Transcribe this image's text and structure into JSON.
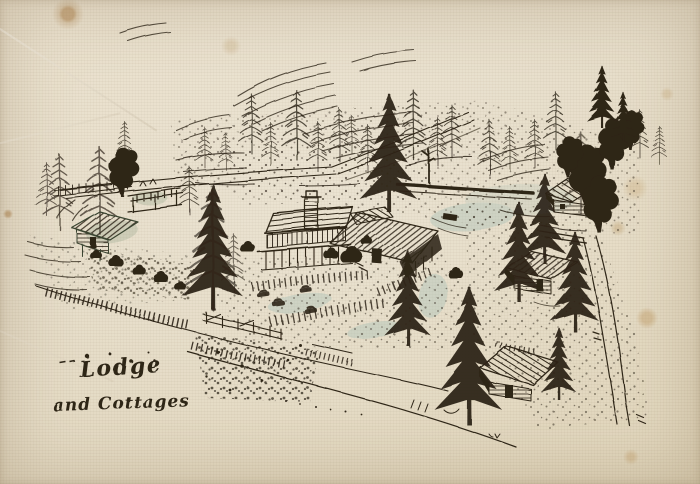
{
  "artwork": {
    "caption": {
      "line1": "Lodge",
      "line2": "and Cottages"
    }
  },
  "colors": {
    "paper": "#e8dfc9",
    "ink": "#2e2519",
    "ink_green": "#3a4430",
    "wash_blue": "#a9c2b8",
    "wash_green": "#93a489",
    "stain": "#b9884e"
  }
}
